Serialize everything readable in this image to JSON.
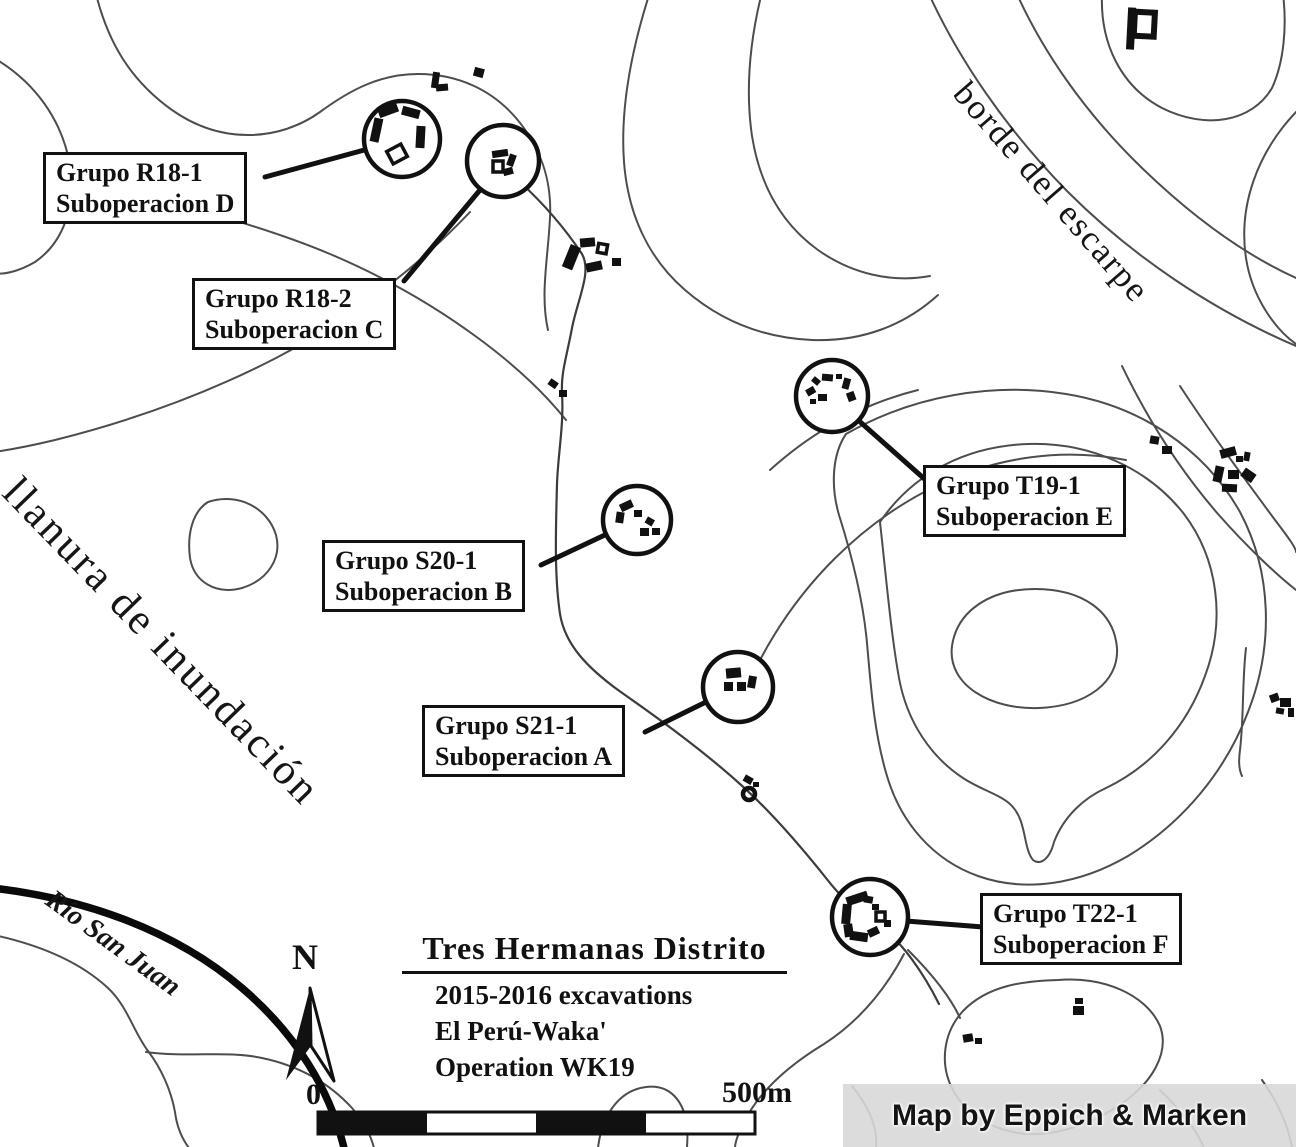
{
  "title_block": {
    "title": "Tres Hermanas Distrito",
    "line1": "2015-2016 excavations",
    "line2": "El Perú-Waka'",
    "line3": "Operation WK19"
  },
  "north": {
    "label": "N"
  },
  "scale_bar": {
    "zero": "0",
    "max": "500m"
  },
  "attribution": {
    "text": "Map by Eppich & Marken"
  },
  "region_labels": {
    "escarpment": "borde del escarpe",
    "floodplain": "llanura de inundación",
    "river": "Río San Juan"
  },
  "sites": [
    {
      "id": "R18-1",
      "group": "Grupo R18-1",
      "subop": "Suboperacion D"
    },
    {
      "id": "R18-2",
      "group": "Grupo R18-2",
      "subop": "Suboperacion C"
    },
    {
      "id": "S20-1",
      "group": "Grupo S20-1",
      "subop": "Suboperacion B"
    },
    {
      "id": "S21-1",
      "group": "Grupo S21-1",
      "subop": "Suboperacion A"
    },
    {
      "id": "T19-1",
      "group": "Grupo T19-1",
      "subop": "Suboperacion E"
    },
    {
      "id": "T22-1",
      "group": "Grupo T22-1",
      "subop": "Suboperacion F"
    }
  ],
  "colors": {
    "background": "#ffffff",
    "ink": "#111111",
    "contour": "#4d4d4d",
    "attribution_bg": "#d9d9d9"
  }
}
